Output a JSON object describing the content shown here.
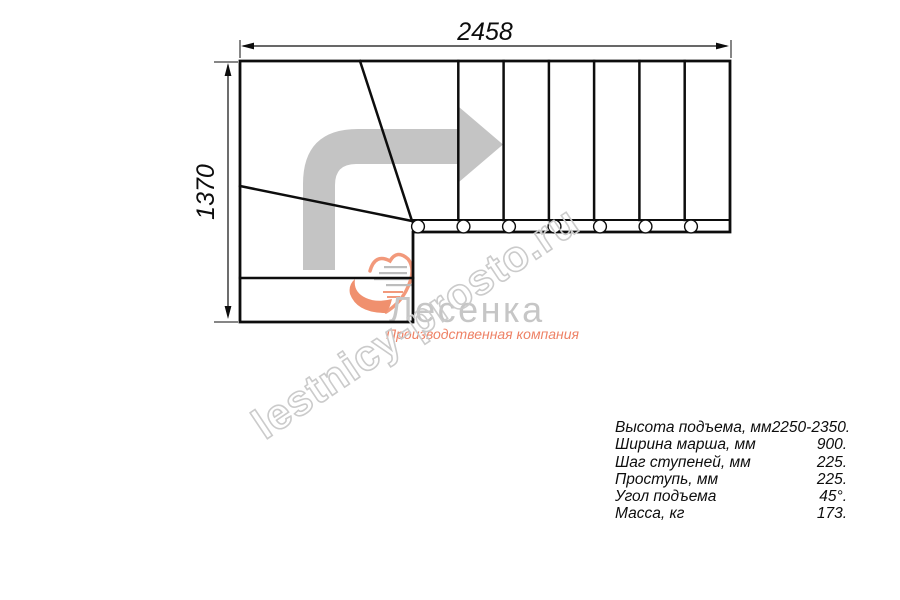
{
  "drawing": {
    "title": "Г-образная лестница — план (вид сверху)",
    "dimensions": {
      "width_label": "2458",
      "height_label": "1370"
    },
    "plan": {
      "straight_steps": 7,
      "stringer_circles": 7,
      "winder_diagonals": 2,
      "direction_arrow": "поворот налево-вверх, затем направо"
    },
    "colors": {
      "line": "#0d0d0d",
      "arrow_gray": "#c4c4c4",
      "watermark_gray": "#cbcbcb",
      "logo_gray": "#c6c6c6",
      "logo_salmon": "#f0906e"
    }
  },
  "watermark": {
    "text": "lestnicy-prosto.ru"
  },
  "logo": {
    "name": "Лесенка",
    "subtitle": "Производственная компания"
  },
  "specs": {
    "rows": [
      {
        "label": "Высота подъема, мм",
        "value": "2250-2350."
      },
      {
        "label": "Ширина марша, мм",
        "value": "900."
      },
      {
        "label": "Шаг ступеней, мм",
        "value": "225."
      },
      {
        "label": "Проступь, мм",
        "value": "225."
      },
      {
        "label": "Угол подъема",
        "value": "45°."
      },
      {
        "label": "Масса, кг",
        "value": "173."
      }
    ]
  }
}
